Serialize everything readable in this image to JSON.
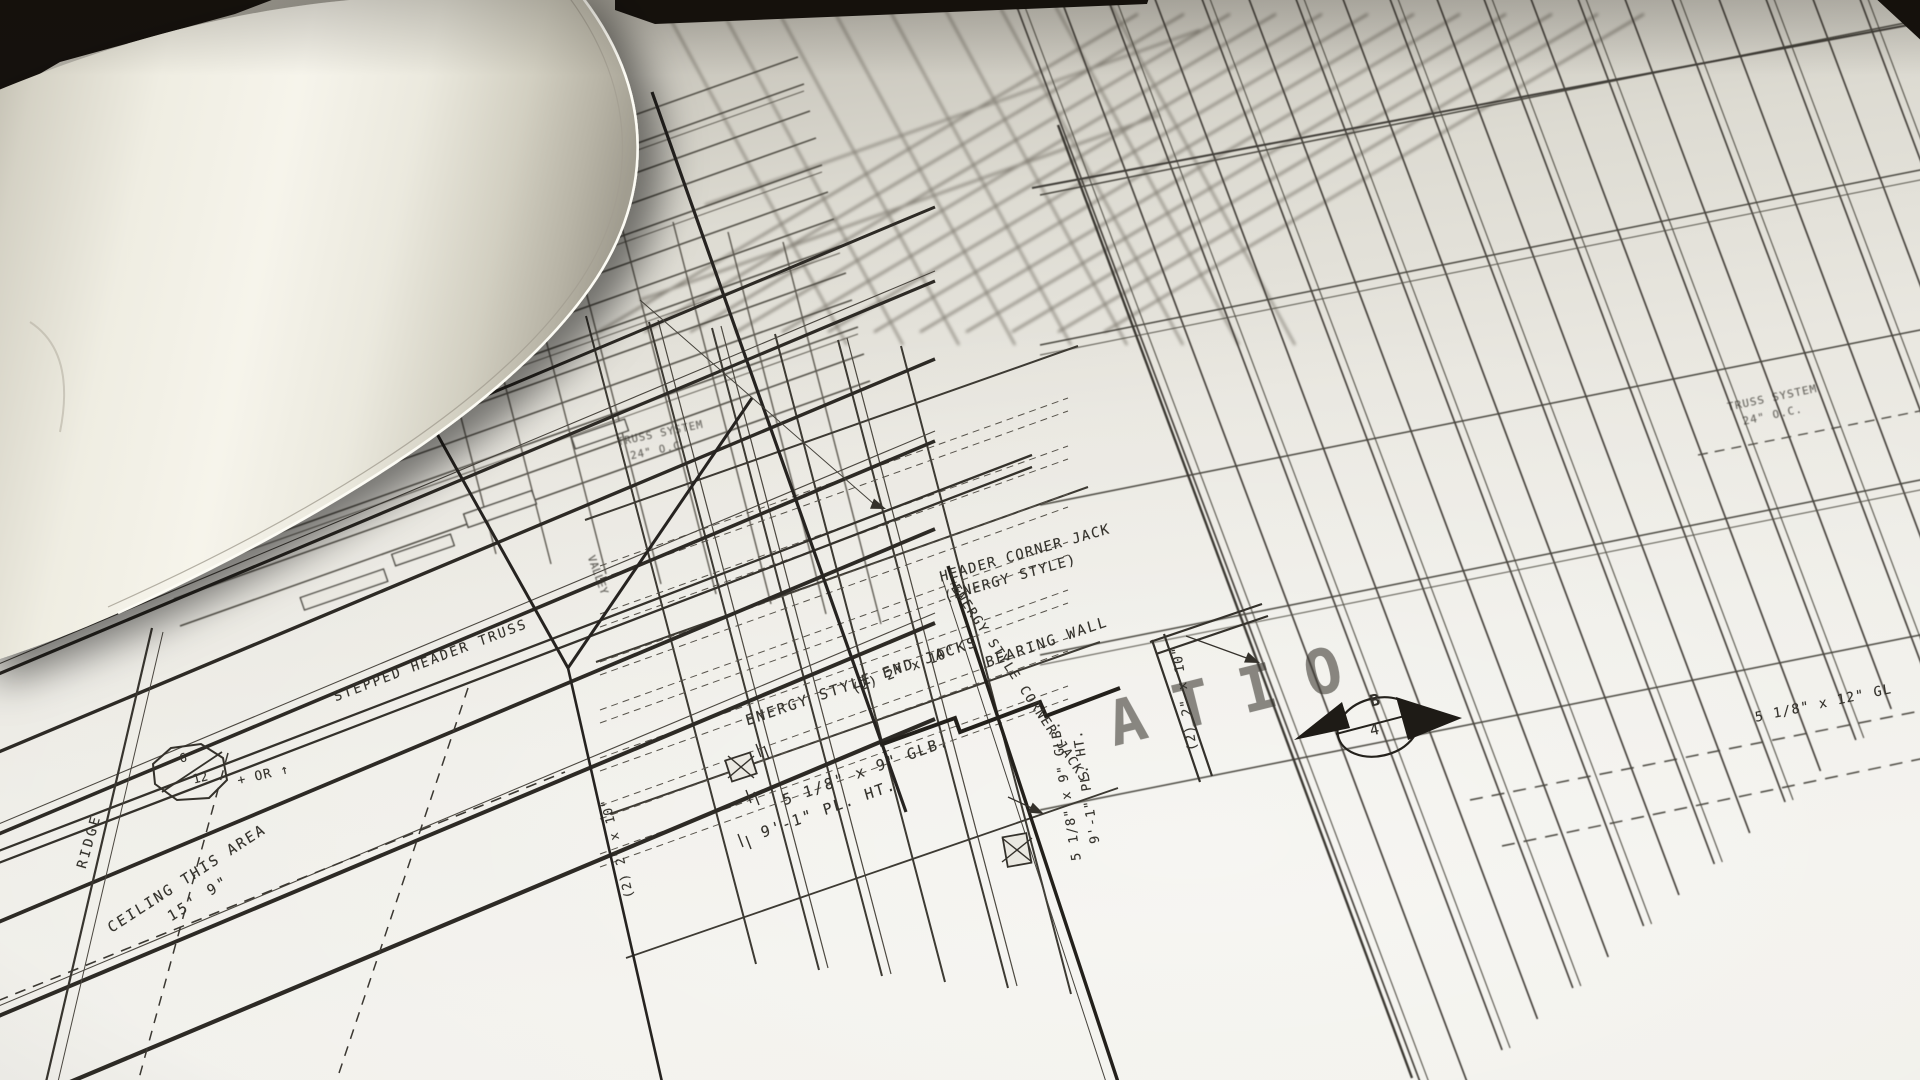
{
  "blueprint": {
    "labels": {
      "stepped_header_truss": "STEPPED HEADER TRUSS",
      "header_corner_jack_1": "HEADER CORNER JACK",
      "header_corner_jack_2": "(ENERGY STYLE)",
      "bearing_wall": "BEARING WALL",
      "energy_end_jacks": "ENERGY STYLE END JACKS",
      "glb_beam_1": "5 1/8\" x 9\" GLB.",
      "glb_beam_2": "9'-1\" PL. HT.",
      "corner_jacks": "ENERGY STYLE CORNER JACKS",
      "two_2x10_h": "(2) 2\" x 10\"",
      "two_2x10_valley": "(2) 2\" x 10\"",
      "two_2x10_vert": "(2) 2\" x 10\"",
      "glb_vert_1": "5 1/8\" x 9\" GLB.",
      "glb_vert_2": "9'-1\" PL. HT.",
      "valley": "VALLEY",
      "ridge": "RIDGE",
      "ceiling_1": "CEILING THIS AREA",
      "ceiling_2": "15' 9\"",
      "pitch_num": "6",
      "pitch_den": "12",
      "pitch_suffix": "+ OR ↑",
      "truss_sys_1": "TRUSS SYSTEM",
      "truss_sys_2": "24\" O.C.",
      "glb_right": "5 1/8\" x 12\" GL",
      "section_b": "B",
      "section_4": "4",
      "watermark": "ATIO"
    }
  }
}
